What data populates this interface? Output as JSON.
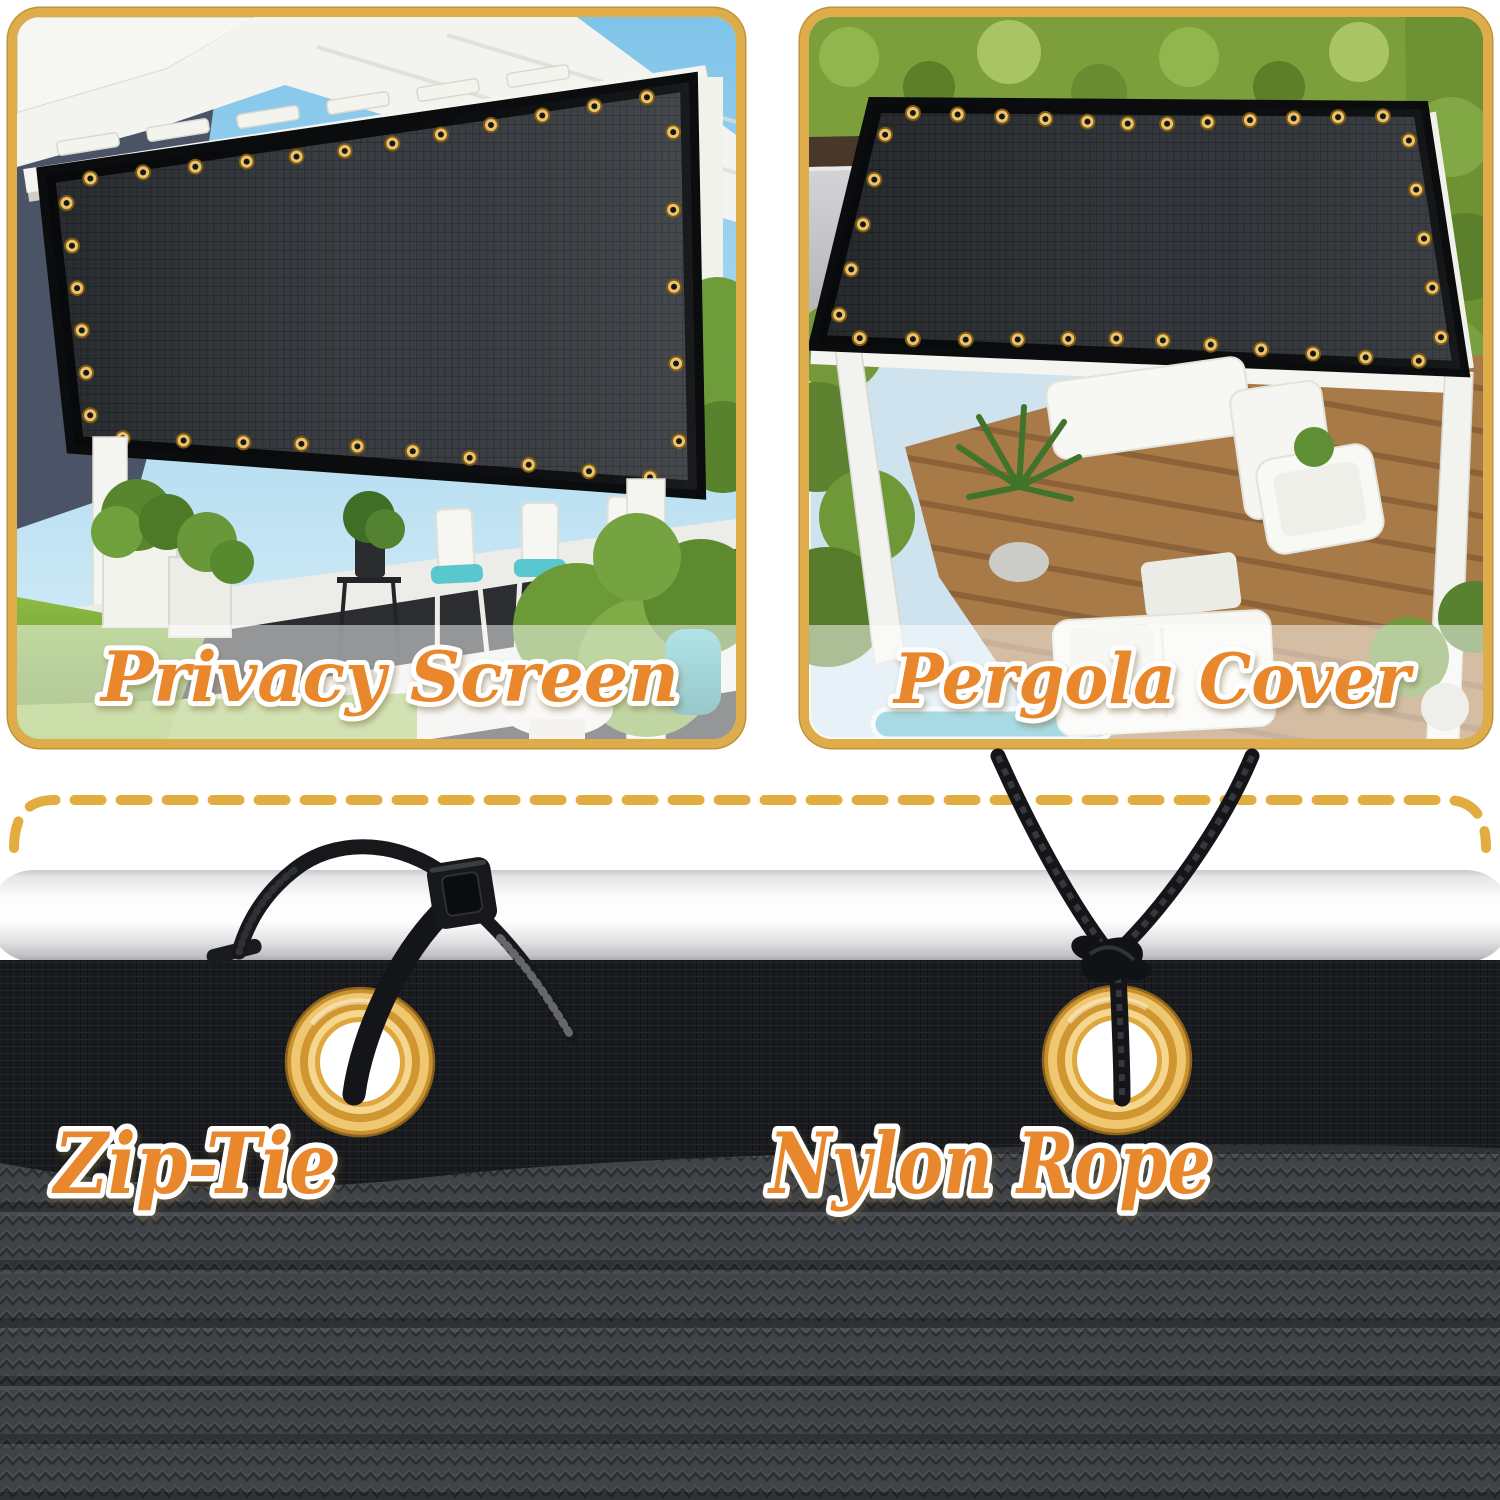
{
  "use_cases": {
    "privacy_screen": "Privacy Screen",
    "pergola_cover": "Pergola Cover"
  },
  "mounting": {
    "zip_tie": "Zip-Tie",
    "nylon_rope": "Nylon Rope"
  },
  "colors": {
    "label_orange": "#E8872B",
    "label_outline": "#FFFFFF",
    "panel_border_gold": "#DEAC4B",
    "dashed_line_gold": "#E2AC3F",
    "grommet_gold": "#D89733",
    "fabric_mesh_black": "#1A1B1E",
    "fabric_knit_gray": "#3F4246",
    "pole_silver": "#E8E9EA",
    "screen_fabric": "#3A3E42"
  }
}
